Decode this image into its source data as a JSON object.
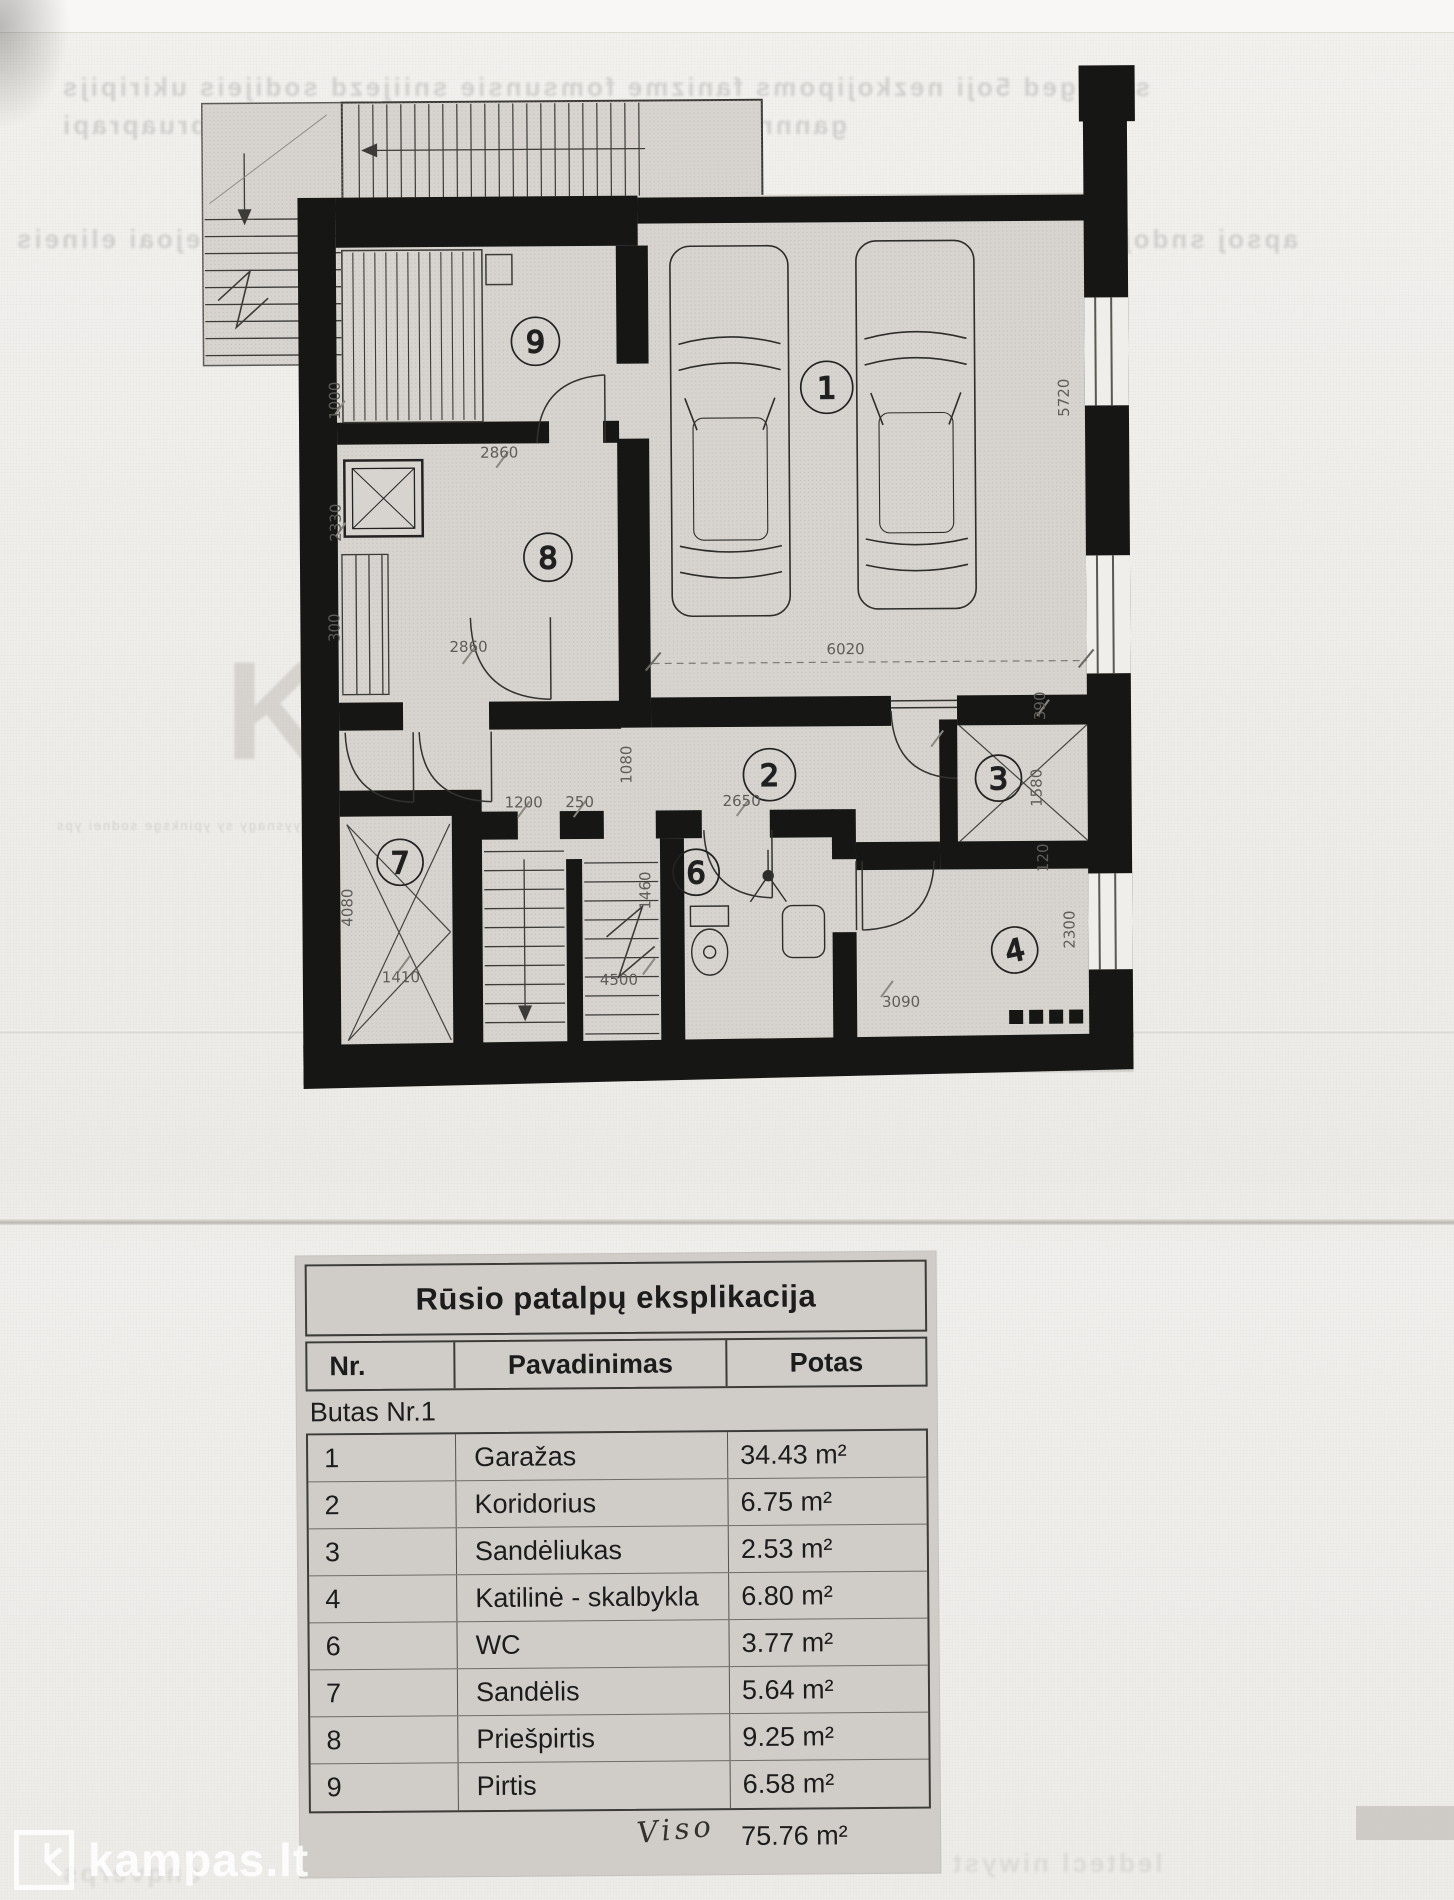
{
  "watermark": {
    "brand": "kampas.lt"
  },
  "floor_plan": {
    "room_numbers": {
      "garage": "1",
      "corridor": "2",
      "storage_small": "3",
      "boiler_laundry": "4",
      "wc": "6",
      "storage": "7",
      "sauna_anteroom": "8",
      "sauna": "9"
    },
    "dimensions": {
      "sauna_width": "2860",
      "anteroom_width": "2860",
      "garage_width": "6020",
      "garage_depth": "5720",
      "stove_width": "1000",
      "left_upper": "2330",
      "left_small": "300",
      "storage7_height": "4080",
      "hall_a": "1200",
      "hall_b": "250",
      "wc_width": "2650",
      "hall_height": "1080",
      "wc_height": "1460",
      "storage3_top": "390",
      "storage3_height": "1580",
      "storage3_bottom": "120",
      "storage7_width": "1410",
      "stairs_length": "4500",
      "boiler_width": "3090",
      "boiler_height": "2300"
    }
  },
  "explication_table": {
    "title": "Rūsio patalpų eksplikacija",
    "columns": [
      "Nr.",
      "Pavadinimas",
      "Potas"
    ],
    "group_row": "Butas Nr.1",
    "rows": [
      [
        "1",
        "Garažas",
        "34.43 m²"
      ],
      [
        "2",
        "Koridorius",
        "6.75 m²"
      ],
      [
        "3",
        "Sandėliukas",
        "2.53 m²"
      ],
      [
        "4",
        "Katilinė - skalbykla",
        "6.80 m²"
      ],
      [
        "6",
        "WC",
        "3.77 m²"
      ],
      [
        "7",
        "Sandėlis",
        "5.64 m²"
      ],
      [
        "8",
        "Priešpirtis",
        "9.25 m²"
      ],
      [
        "9",
        "Pirtis",
        "6.58 m²"
      ]
    ],
    "total_label": "Viso",
    "total_value": "75.76 m²"
  },
  "bleed_through": {
    "line1": "seiluged 5oji nezkojipoms fanizme fomsunsie sniijezd sodijeis ukiripijs",
    "line2": "gannress nonneismia s omninios eisnyda pruaprapi",
    "line3": "opiejoai elineis",
    "line4": "apsoj sndoji knisotelis",
    "line5": "ruy pasnyd sepyojuo xaus emy pysy yysnagy sy ypinksge sodnei yps",
    "line6": "ledtecl niwyst",
    "line7": "dnqverps"
  },
  "ghosts": {
    "k": "K",
    "kampas": "kampas"
  }
}
